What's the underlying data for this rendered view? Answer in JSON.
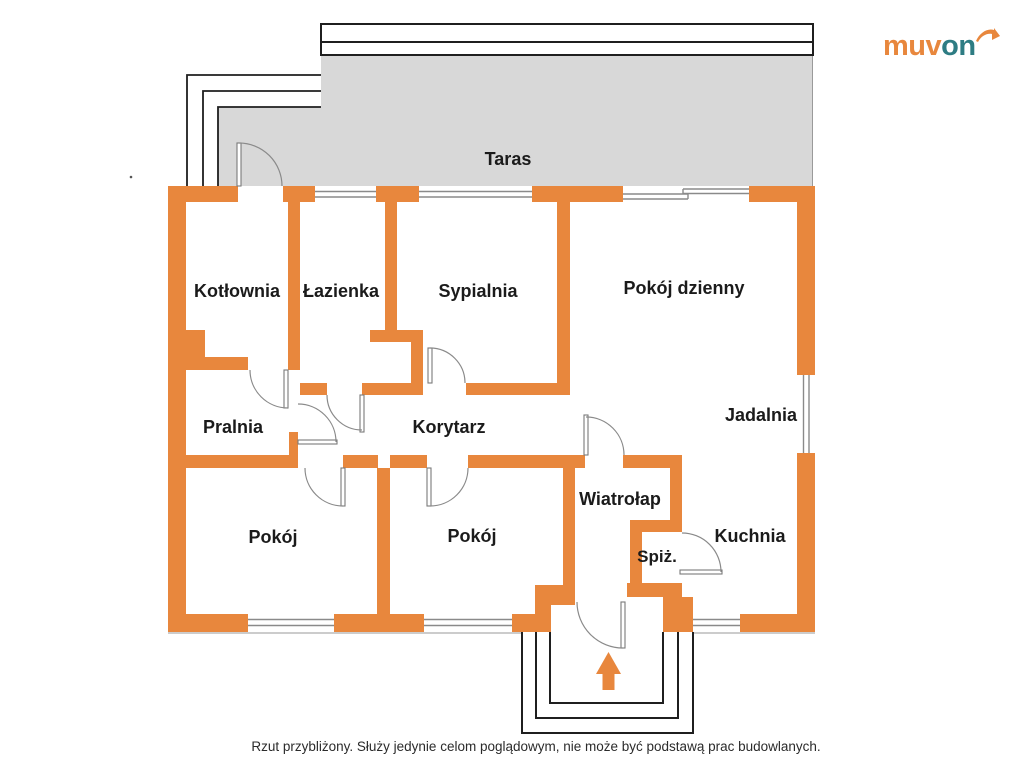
{
  "brand": {
    "logo_primary": "muv",
    "logo_secondary": "on",
    "logo_arrow_icon": "arrow-swoosh-icon"
  },
  "labels": {
    "taras": "Taras",
    "kotlownia": "Kotłownia",
    "lazienka": "Łazienka",
    "sypialnia": "Sypialnia",
    "pokoj_dzienny": "Pokój dzienny",
    "pralnia": "Pralnia",
    "korytarz": "Korytarz",
    "jadalnia": "Jadalnia",
    "wiatrolap": "Wiatrołap",
    "spiz": "Spiż.",
    "kuchnia": "Kuchnia",
    "pokoj_1": "Pokój",
    "pokoj_2": "Pokój"
  },
  "disclaimer": "Rzut przybliżony. Służy jedynie celom poglądowym, nie może być podstawą prac budowlanych.",
  "icons": {
    "entrance_arrow": "arrow-up-icon"
  },
  "colors": {
    "wall_orange": "#E8873D",
    "terrace_gray": "#D8D8D8",
    "logo_orange": "#E8873D",
    "logo_teal": "#2E7C83",
    "label_text": "#1B1B1B"
  }
}
